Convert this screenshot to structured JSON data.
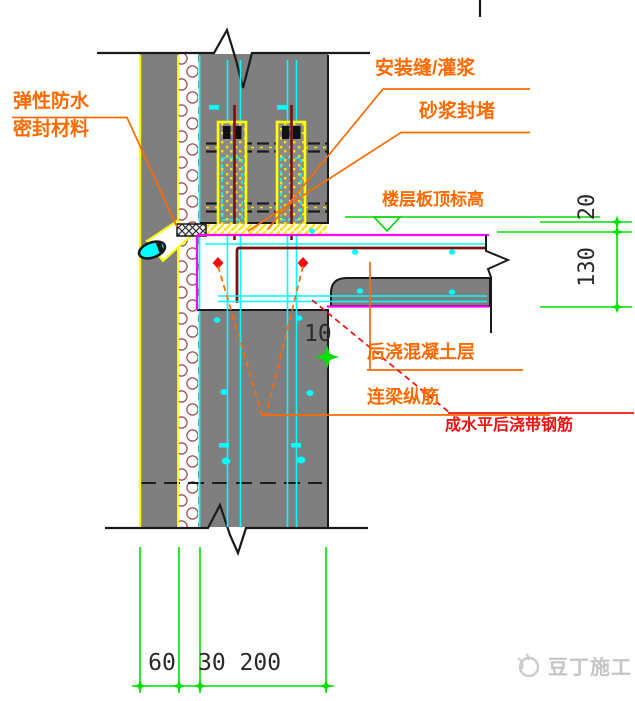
{
  "labels": {
    "elastic_line1": "弹性防水",
    "elastic_line2": "密封材料",
    "install_seam": "安装缝/灌浆",
    "mortar_seal": "砂浆封堵",
    "floor_elevation": "楼层板顶标高",
    "post_cast_layer": "后浇混凝土层",
    "coupling_rebar": "连梁纵筋",
    "band_rebar": "成水平后浇带钢筋"
  },
  "dimensions": {
    "seam_thickness": "20",
    "slab_thickness": "130",
    "plank_gap": "10",
    "outer_leaf_width": "60",
    "insulation_inner_width": "30 200"
  },
  "watermark": {
    "text": "豆丁施工"
  },
  "colors": {
    "concrete_gray": "#7f7f7f",
    "rebar_cyan": "#00ffff",
    "grout_yellow": "#ffff00",
    "boundary_magenta": "#ff00ff",
    "dimension_green": "#00e000",
    "label_orange": "#ff6a00",
    "warning_red": "#f01010",
    "bar_maroon": "#7a1010"
  }
}
